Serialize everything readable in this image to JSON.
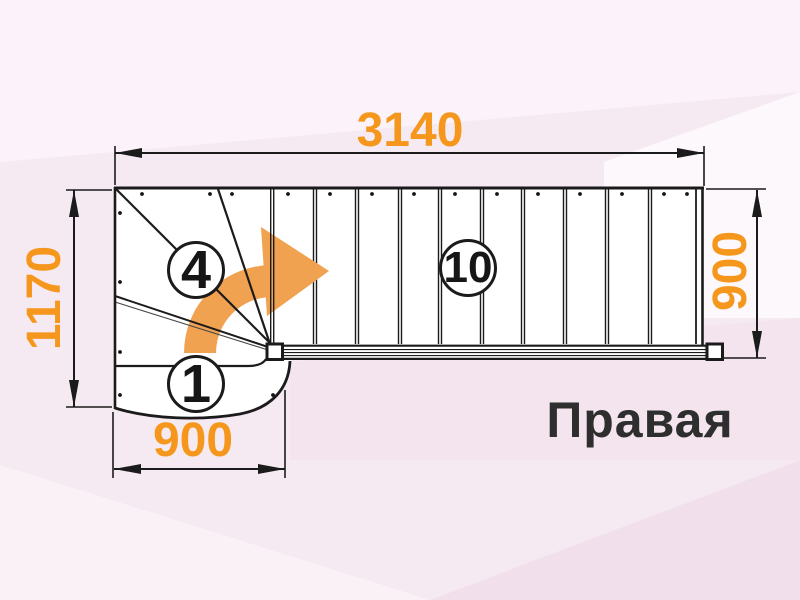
{
  "diagram": {
    "type": "staircase-floor-plan",
    "orientation_label": "Правая",
    "dimensions": {
      "total_length": "3140",
      "left_height": "1170",
      "bottom_width": "900",
      "right_height": "900"
    },
    "step_labels": {
      "first_step": "1",
      "winder_last": "4",
      "straight_flight": "10"
    },
    "colors": {
      "dimension": "#f5971d",
      "arrow": "#f0a251",
      "line": "#1b1b1b",
      "label": "#2e2e2e",
      "bg": "#f6eaf2"
    }
  }
}
